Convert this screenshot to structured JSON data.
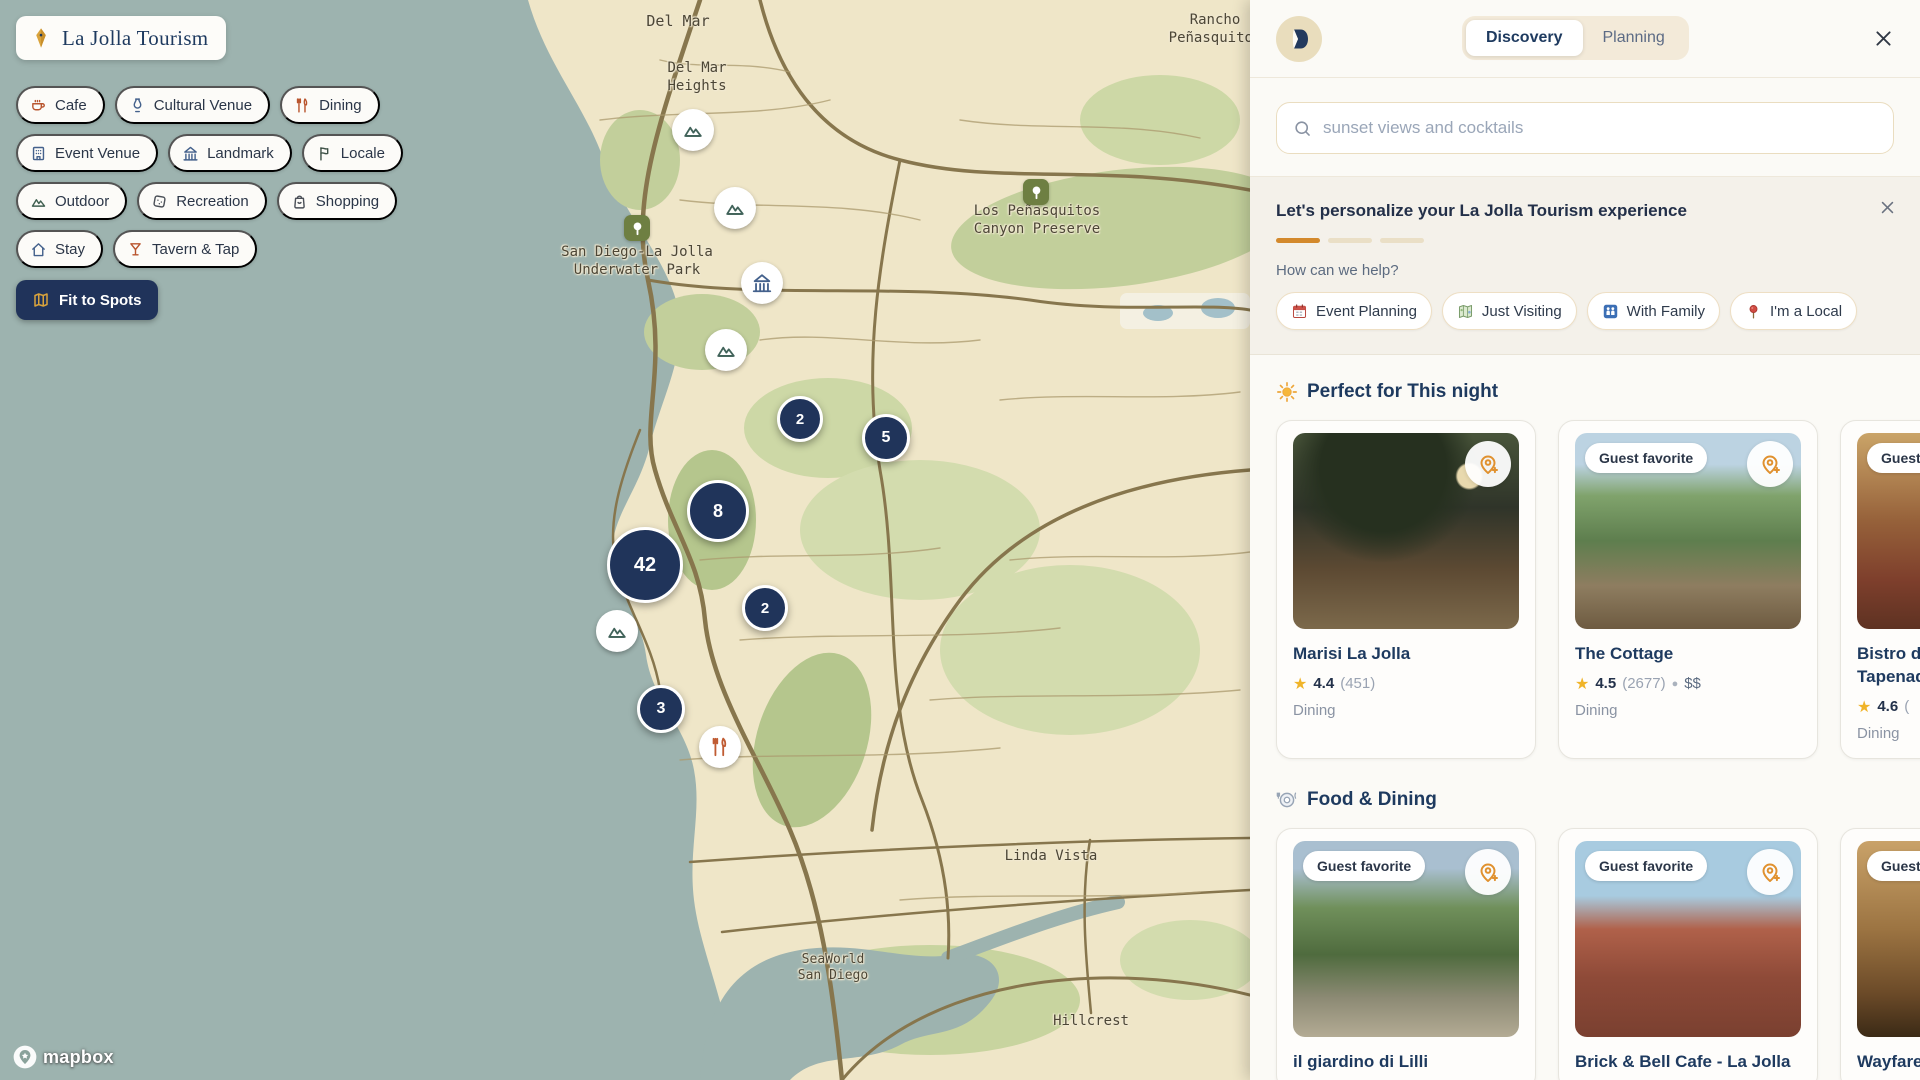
{
  "map": {
    "logo_pill": {
      "label": "La Jolla Tourism"
    },
    "fit_button": {
      "label": "Fit to Spots"
    },
    "attribution": "mapbox",
    "filter_chips": [
      {
        "label": "Cafe",
        "icon": "coffee-icon",
        "color": "#b9552e"
      },
      {
        "label": "Cultural Venue",
        "icon": "vase-icon",
        "color": "#44618c"
      },
      {
        "label": "Dining",
        "icon": "utensils-icon",
        "color": "#b9552e"
      },
      {
        "label": "Event Venue",
        "icon": "building-icon",
        "color": "#44618c"
      },
      {
        "label": "Landmark",
        "icon": "landmark-icon",
        "color": "#44618c"
      },
      {
        "label": "Locale",
        "icon": "flag-icon",
        "color": "#3f5248"
      },
      {
        "label": "Outdoor",
        "icon": "mountains-icon",
        "color": "#3f5f50"
      },
      {
        "label": "Recreation",
        "icon": "dice-icon",
        "color": "#4a4f57"
      },
      {
        "label": "Shopping",
        "icon": "bag-icon",
        "color": "#4a4f57"
      },
      {
        "label": "Stay",
        "icon": "home-icon",
        "color": "#44618c"
      },
      {
        "label": "Tavern & Tap",
        "icon": "martini-icon",
        "color": "#b9552e"
      }
    ],
    "clusters": [
      {
        "count": "2",
        "x": 800,
        "y": 419,
        "size": 46,
        "font": 15
      },
      {
        "count": "5",
        "x": 886,
        "y": 438,
        "size": 48,
        "font": 16
      },
      {
        "count": "8",
        "x": 718,
        "y": 511,
        "size": 62,
        "font": 18
      },
      {
        "count": "42",
        "x": 645,
        "y": 565,
        "size": 76,
        "font": 20
      },
      {
        "count": "2",
        "x": 765,
        "y": 608,
        "size": 46,
        "font": 15
      },
      {
        "count": "3",
        "x": 661,
        "y": 709,
        "size": 48,
        "font": 16
      }
    ],
    "poi_markers": [
      {
        "icon": "mountain-icon",
        "x": 693,
        "y": 130,
        "color": "#41635a"
      },
      {
        "icon": "mountain-icon",
        "x": 735,
        "y": 208,
        "color": "#41635a"
      },
      {
        "icon": "museum-icon",
        "x": 762,
        "y": 283,
        "color": "#44618c"
      },
      {
        "icon": "mountain-icon",
        "x": 726,
        "y": 350,
        "color": "#41635a"
      },
      {
        "icon": "mountain-icon",
        "x": 617,
        "y": 631,
        "color": "#41635a"
      },
      {
        "icon": "restaurant-icon",
        "x": 720,
        "y": 747,
        "color": "#c05c33"
      }
    ],
    "tree_markers": [
      {
        "x": 637,
        "y": 228
      },
      {
        "x": 1036,
        "y": 192
      }
    ],
    "place_labels": [
      {
        "text": "Del Mar",
        "x": 678,
        "y": 12,
        "size": 15
      },
      {
        "text": "Del Mar\nHeights",
        "x": 697,
        "y": 60,
        "size": 14
      },
      {
        "text": "Rancho\nPeñasquitos",
        "x": 1215,
        "y": 12,
        "size": 14
      },
      {
        "text": "Los Peñasquitos\nCanyon Preserve",
        "x": 1037,
        "y": 203,
        "size": 14
      },
      {
        "text": "San Diego-La Jolla\nUnderwater Park",
        "x": 637,
        "y": 244,
        "size": 14
      },
      {
        "text": "Linda Vista",
        "x": 1051,
        "y": 848,
        "size": 14
      },
      {
        "text": "SeaWorld\nSan Diego",
        "x": 833,
        "y": 952,
        "size": 13
      },
      {
        "text": "Hillcrest",
        "x": 1091,
        "y": 1013,
        "size": 14
      }
    ]
  },
  "sidebar": {
    "tabs": [
      {
        "label": "Discovery",
        "active": true
      },
      {
        "label": "Planning",
        "active": false
      }
    ],
    "search": {
      "placeholder": "sunset views and cocktails"
    },
    "personalize": {
      "title": "Let's personalize your La Jolla Tourism experience",
      "progress": [
        1,
        0,
        0
      ],
      "question": "How can we help?",
      "options": [
        {
          "icon": "calendar-emoji-icon",
          "label": "Event Planning"
        },
        {
          "icon": "worldmap-emoji-icon",
          "label": "Just Visiting"
        },
        {
          "icon": "family-emoji-icon",
          "label": "With Family"
        },
        {
          "icon": "roundpin-emoji-icon",
          "label": "I'm a Local"
        }
      ]
    },
    "sections": [
      {
        "icon": "sun-emoji-icon",
        "title": "Perfect for This night",
        "cards": [
          {
            "badge": null,
            "name": "Marisi La Jolla",
            "rating": "4.4",
            "reviews": "(451)",
            "price": null,
            "category": "Dining",
            "photo": "marisi"
          },
          {
            "badge": "Guest favorite",
            "name": "The Cottage",
            "rating": "4.5",
            "reviews": "(2677)",
            "price": "$$",
            "category": "Dining",
            "photo": "cottage"
          },
          {
            "badge": "Guest favorite",
            "name": "Bistro du Marché by Tapenade",
            "rating": "4.6",
            "reviews": "(",
            "price": null,
            "category": "Dining",
            "photo": "bistro"
          }
        ]
      },
      {
        "icon": "plate-emoji-icon",
        "title": "Food & Dining",
        "cards": [
          {
            "badge": "Guest favorite",
            "name": "il giardino di Lilli",
            "rating": null,
            "reviews": null,
            "price": null,
            "category": null,
            "photo": "giardino"
          },
          {
            "badge": "Guest favorite",
            "name": "Brick & Bell Cafe - La Jolla",
            "rating": null,
            "reviews": null,
            "price": null,
            "category": null,
            "photo": "brick"
          },
          {
            "badge": "Guest favorite",
            "name": "Wayfarer",
            "rating": null,
            "reviews": null,
            "price": null,
            "category": null,
            "photo": "wayfarer"
          }
        ]
      }
    ]
  }
}
